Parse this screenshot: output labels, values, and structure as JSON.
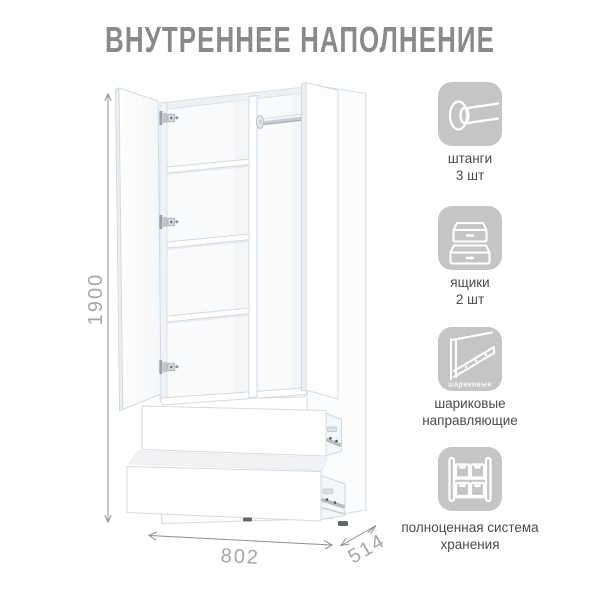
{
  "title": "ВНУТРЕННЕЕ НАПОЛНЕНИЕ",
  "diagram": {
    "subject": "wardrobe-internal-layout",
    "dimensions": {
      "height": "1900",
      "width": "802",
      "depth": "514"
    }
  },
  "features": [
    {
      "icon": "rod-icon",
      "label_line1": "штанги",
      "label_line2": "3 шт"
    },
    {
      "icon": "drawers-icon",
      "label_line1": "ящики",
      "label_line2": "2 шт"
    },
    {
      "icon": "slide-icon",
      "label_line1": "шариковые",
      "label_line2": "направляющие",
      "icon_caption": "шариковые"
    },
    {
      "icon": "storage-icon",
      "label_line1": "полноценная система",
      "label_line2": "хранения"
    }
  ],
  "colors": {
    "title_text": "#8a8a8a",
    "icon_tile": "#c4c5c7",
    "feature_label": "#4b4b4d",
    "dimension_text": "#a6a6a6",
    "dimension_line": "#8f8f8f",
    "drawing_outline": "#d6dade"
  }
}
